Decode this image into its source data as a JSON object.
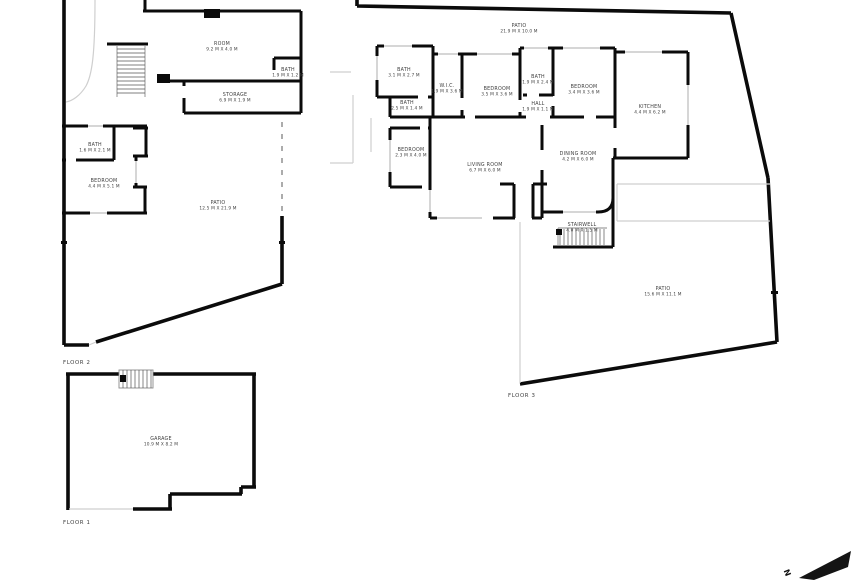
{
  "document": {
    "type": "residential floor plan, 3 levels"
  },
  "colors": {
    "wall": "#0b0b0b",
    "background": "#ffffff",
    "window": "#c9c9c9",
    "thin_line": "#cfcfcf",
    "text": "#3f3f3f"
  },
  "compass": {
    "label": "N"
  },
  "floors": [
    {
      "id": "floor-2",
      "label": "FLOOR 2",
      "label_x": 63,
      "label_y": 364,
      "rooms": [
        {
          "name": "ROOM",
          "dims": "9.2 M X 4.0 M",
          "x": 222,
          "y": 45
        },
        {
          "name": "BATH",
          "dims": "1.9 M X 1.2 M",
          "x": 288,
          "y": 71
        },
        {
          "name": "STORAGE",
          "dims": "6.9 M X 1.9 M",
          "x": 235,
          "y": 96
        },
        {
          "name": "BATH",
          "dims": "1.6 M X 2.1 M",
          "x": 95,
          "y": 146
        },
        {
          "name": "BEDROOM",
          "dims": "4.4 M X 5.1 M",
          "x": 104,
          "y": 182
        },
        {
          "name": "PATIO",
          "dims": "12.5 M X 21.9 M",
          "x": 218,
          "y": 204
        }
      ]
    },
    {
      "id": "floor-3",
      "label": "FLOOR 3",
      "label_x": 508,
      "label_y": 397,
      "rooms": [
        {
          "name": "PATIO",
          "dims": "21.9 M X 10.0 M",
          "x": 519,
          "y": 27
        },
        {
          "name": "BATH",
          "dims": "3.1 M X 2.7 M",
          "x": 404,
          "y": 71
        },
        {
          "name": "W.I.C.",
          "dims": "1.9 M X 3.6 M",
          "x": 447,
          "y": 87
        },
        {
          "name": "BEDROOM",
          "dims": "3.5 M X 3.6 M",
          "x": 497,
          "y": 90
        },
        {
          "name": "BATH",
          "dims": "1.9 M X 2.4 M",
          "x": 538,
          "y": 78
        },
        {
          "name": "HALL",
          "dims": "1.9 M X 1.1 M",
          "x": 538,
          "y": 105
        },
        {
          "name": "BEDROOM",
          "dims": "3.4 M X 3.6 M",
          "x": 584,
          "y": 88
        },
        {
          "name": "KITCHEN",
          "dims": "4.4 M X 6.2 M",
          "x": 650,
          "y": 108
        },
        {
          "name": "BATH",
          "dims": "2.5 M X 1.4 M",
          "x": 407,
          "y": 104
        },
        {
          "name": "BEDROOM",
          "dims": "2.3 M X 4.0 M",
          "x": 411,
          "y": 151
        },
        {
          "name": "LIVING ROOM",
          "dims": "6.7 M X 6.0 M",
          "x": 485,
          "y": 166
        },
        {
          "name": "DINING ROOM",
          "dims": "4.2 M X 6.0 M",
          "x": 578,
          "y": 155
        },
        {
          "name": "STAIRWELL",
          "dims": "4.0 M X 1.5 M",
          "x": 582,
          "y": 226
        },
        {
          "name": "PATIO",
          "dims": "15.6 M X 11.1 M",
          "x": 663,
          "y": 290
        }
      ]
    },
    {
      "id": "floor-1",
      "label": "FLOOR 1",
      "label_x": 63,
      "label_y": 524,
      "rooms": [
        {
          "name": "GARAGE",
          "dims": "10.9 M X 8.2 M",
          "x": 161,
          "y": 440
        }
      ]
    }
  ]
}
